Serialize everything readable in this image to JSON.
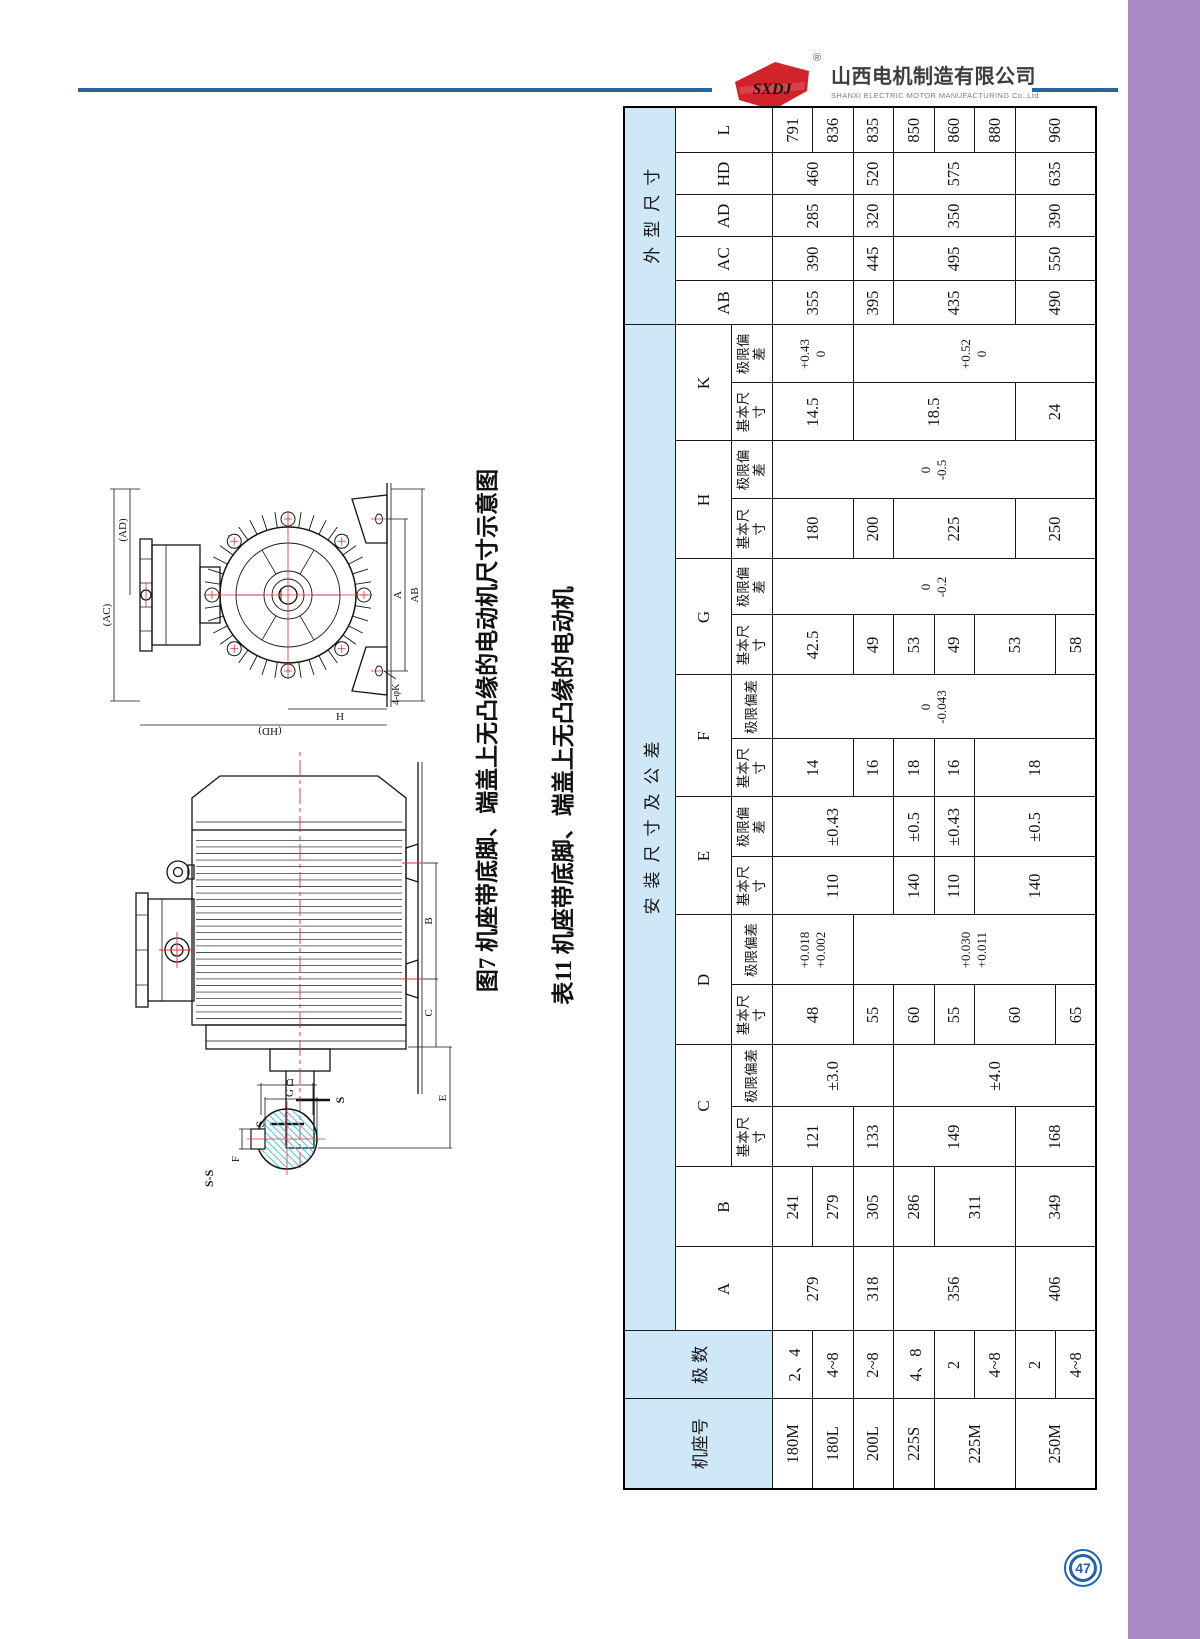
{
  "page": {
    "number": "47"
  },
  "colors": {
    "sidebar_purple": "#a98cc2",
    "header_line_blue": "#24679f",
    "logo_red": "#d2232a",
    "badge_blue": "#1f63ae",
    "table_header_blue": "#cfe8f7",
    "drawing_red": "#e03131",
    "hatch_cyan": "#4cc3de"
  },
  "header": {
    "logo_text": "SXDJ",
    "registered_mark": "®",
    "company_cn": "山西电机制造有限公司",
    "company_en": "SHANXI ELECTRIC MOTOR MANUFACTURING Co.,Ltd."
  },
  "drawings": {
    "figure_caption": "图7 机座带底脚、端盖上无凸缘的电动机尺寸示意图",
    "front": {
      "ac": "(AC)",
      "ad": "(AD)",
      "a": "A",
      "ab": "AB",
      "h": "H",
      "hd": "(HD)",
      "foot_holes": "4-φK"
    },
    "side": {
      "b": "B",
      "c": "C",
      "e": "E",
      "s_left": "S",
      "s_right": "S"
    },
    "section": {
      "title": "S-S",
      "f": "F",
      "g": "G",
      "d": "D"
    }
  },
  "table": {
    "title": "表11 机座带底脚、端盖上无凸缘的电动机",
    "header_rows": [
      [
        {
          "t": "机座号",
          "rs": 3,
          "k": "blue"
        },
        {
          "t": "极 数",
          "rs": 3,
          "k": "blue"
        },
        {
          "t": "安装尺寸及公差",
          "cs": 16,
          "k": "blue sp"
        },
        {
          "t": "外型尺寸",
          "cs": 5,
          "k": "blue sp"
        }
      ],
      [
        {
          "t": "A",
          "rs": 2
        },
        {
          "t": "B",
          "rs": 2
        },
        {
          "t": "C",
          "cs": 2
        },
        {
          "t": "D",
          "cs": 2
        },
        {
          "t": "E",
          "cs": 2
        },
        {
          "t": "F",
          "cs": 2
        },
        {
          "t": "G",
          "cs": 2
        },
        {
          "t": "H",
          "cs": 2
        },
        {
          "t": "K",
          "cs": 2
        },
        {
          "t": "AB",
          "rs": 2
        },
        {
          "t": "AC",
          "rs": 2
        },
        {
          "t": "AD",
          "rs": 2
        },
        {
          "t": "HD",
          "rs": 2
        },
        {
          "t": "L",
          "rs": 2
        }
      ],
      [
        {
          "t": "基本尺寸",
          "k": "lbl"
        },
        {
          "t": "极限偏差",
          "k": "lbl"
        },
        {
          "t": "基本尺寸",
          "k": "lbl"
        },
        {
          "t": "极限偏差",
          "k": "lbl"
        },
        {
          "t": "基本尺寸",
          "k": "lbl"
        },
        {
          "t": "极限偏差",
          "k": "lbl"
        },
        {
          "t": "基本尺寸",
          "k": "lbl"
        },
        {
          "t": "极限偏差",
          "k": "lbl"
        },
        {
          "t": "基本尺寸",
          "k": "lbl"
        },
        {
          "t": "极限偏差",
          "k": "lbl"
        },
        {
          "t": "基本尺寸",
          "k": "lbl"
        },
        {
          "t": "极限偏差",
          "k": "lbl"
        },
        {
          "t": "基本尺寸",
          "k": "lbl"
        },
        {
          "t": "极限偏差",
          "k": "lbl"
        }
      ]
    ],
    "body_rows": [
      [
        {
          "t": "180M"
        },
        {
          "t": "2、4"
        },
        {
          "t": "279",
          "rs": 2
        },
        {
          "t": "241"
        },
        {
          "t": "121",
          "rs": 2
        },
        {
          "t": "±3.0",
          "rs": 3
        },
        {
          "t": "48",
          "rs": 2
        },
        {
          "t": "+0.018\n+0.002",
          "rs": 2,
          "k": "tol"
        },
        {
          "t": "110",
          "rs": 3
        },
        {
          "t": "±0.43",
          "rs": 3
        },
        {
          "t": "14",
          "rs": 2
        },
        {
          "t": "0\n-0.043",
          "rs": 8,
          "k": "tol"
        },
        {
          "t": "42.5",
          "rs": 2
        },
        {
          "t": "0\n-0.2",
          "rs": 8,
          "k": "tol"
        },
        {
          "t": "180",
          "rs": 2
        },
        {
          "t": "0\n-0.5",
          "rs": 8,
          "k": "tol"
        },
        {
          "t": "14.5",
          "rs": 2
        },
        {
          "t": "+0.43\n0",
          "rs": 2,
          "k": "tol"
        },
        {
          "t": "355",
          "rs": 2
        },
        {
          "t": "390",
          "rs": 2
        },
        {
          "t": "285",
          "rs": 2
        },
        {
          "t": "460",
          "rs": 2
        },
        {
          "t": "791"
        }
      ],
      [
        {
          "t": "180L"
        },
        {
          "t": "4~8"
        },
        {
          "t": "279"
        },
        {
          "t": "836"
        }
      ],
      [
        {
          "t": "200L"
        },
        {
          "t": "2~8"
        },
        {
          "t": "318"
        },
        {
          "t": "305"
        },
        {
          "t": "133"
        },
        {
          "t": "55"
        },
        {
          "t": "+0.030\n+0.011",
          "rs": 6,
          "k": "tol"
        },
        {
          "t": "16"
        },
        {
          "t": "49"
        },
        {
          "t": "200"
        },
        {
          "t": "18.5",
          "rs": 4
        },
        {
          "t": "+0.52\n0",
          "rs": 6,
          "k": "tol"
        },
        {
          "t": "395"
        },
        {
          "t": "445"
        },
        {
          "t": "320"
        },
        {
          "t": "520"
        },
        {
          "t": "835"
        }
      ],
      [
        {
          "t": "225S"
        },
        {
          "t": "4、8"
        },
        {
          "t": "356",
          "rs": 3
        },
        {
          "t": "286"
        },
        {
          "t": "149",
          "rs": 3
        },
        {
          "t": "±4.0",
          "rs": 5
        },
        {
          "t": "60"
        },
        {
          "t": "140"
        },
        {
          "t": "±0.5"
        },
        {
          "t": "18"
        },
        {
          "t": "53"
        },
        {
          "t": "225",
          "rs": 3
        },
        {
          "t": "435",
          "rs": 3
        },
        {
          "t": "495",
          "rs": 3
        },
        {
          "t": "350",
          "rs": 3
        },
        {
          "t": "575",
          "rs": 3
        },
        {
          "t": "850"
        }
      ],
      [
        {
          "t": "225M",
          "rs": 2
        },
        {
          "t": "2"
        },
        {
          "t": "311",
          "rs": 2
        },
        {
          "t": "55"
        },
        {
          "t": "110"
        },
        {
          "t": "±0.43"
        },
        {
          "t": "16"
        },
        {
          "t": "49"
        },
        {
          "t": "860"
        }
      ],
      [
        {
          "t": "4~8"
        },
        {
          "t": "60",
          "rs": 2
        },
        {
          "t": "140",
          "rs": 3
        },
        {
          "t": "±0.5",
          "rs": 3
        },
        {
          "t": "18",
          "rs": 3
        },
        {
          "t": "53",
          "rs": 2
        },
        {
          "t": "880"
        }
      ],
      [
        {
          "t": "250M",
          "rs": 2
        },
        {
          "t": "2"
        },
        {
          "t": "406",
          "rs": 2
        },
        {
          "t": "349",
          "rs": 2
        },
        {
          "t": "168",
          "rs": 2
        },
        {
          "t": "250",
          "rs": 2
        },
        {
          "t": "24",
          "rs": 2
        },
        {
          "t": "490",
          "rs": 2
        },
        {
          "t": "550",
          "rs": 2
        },
        {
          "t": "390",
          "rs": 2
        },
        {
          "t": "635",
          "rs": 2
        },
        {
          "t": "960",
          "rs": 2
        }
      ],
      [
        {
          "t": "4~8"
        },
        {
          "t": "65"
        },
        {
          "t": "58"
        }
      ]
    ]
  }
}
